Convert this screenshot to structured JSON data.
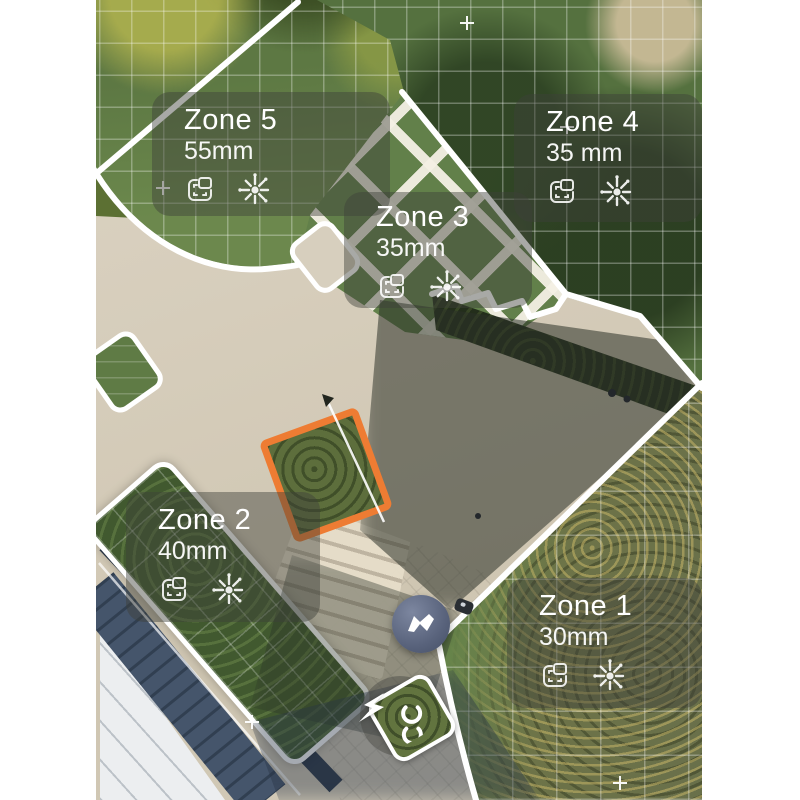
{
  "app": {
    "view_name": "robot-mower-map",
    "description": "Aerial drone map with mowing zones"
  },
  "zones": [
    {
      "name": "Zone 1",
      "cut_height": "30mm"
    },
    {
      "name": "Zone 2",
      "cut_height": "40mm"
    },
    {
      "name": "Zone 3",
      "cut_height": "35mm"
    },
    {
      "name": "Zone 4",
      "cut_height": "35 mm"
    },
    {
      "name": "Zone 5",
      "cut_height": "55mm"
    }
  ],
  "card_icons": {
    "area_icon": "zone-area-icon",
    "burst_icon": "mow-burst-icon"
  },
  "markers": {
    "robot_logo": "mammotion-m-logo",
    "charge_station": "charge-station-marker",
    "charge_badge": "lightning-bolt-icon"
  },
  "colors": {
    "selection_orange": "#EE7C33",
    "boundary_white": "#FFFFFF",
    "card_overlay": "rgba(62,64,58,0.45)",
    "robot_marker": "#59637C"
  }
}
